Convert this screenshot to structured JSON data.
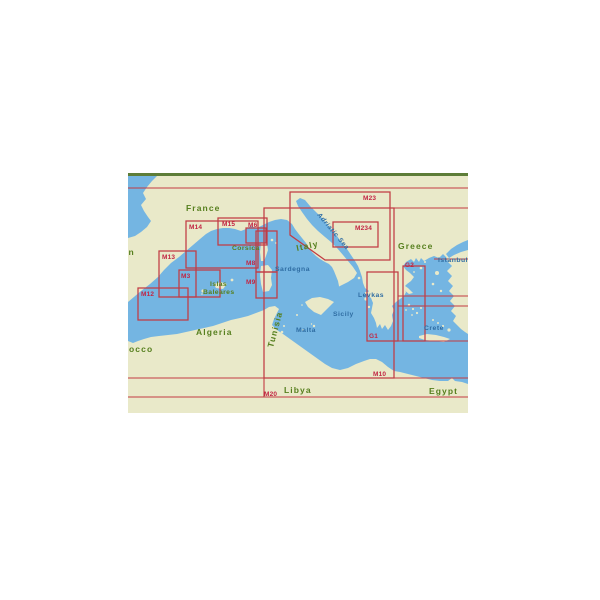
{
  "map": {
    "colors": {
      "sea": "#74b5e2",
      "land": "#e9e9c9",
      "red": "#c23b43",
      "red_text": "#c22543",
      "green_text": "#567f1e",
      "blue_text": "#2f6da3",
      "border_green": "#5d7d38",
      "background": "#ffffff"
    },
    "place_labels": [
      {
        "text": "France",
        "x": 186,
        "y": 211,
        "cls": "country",
        "rot": 0
      },
      {
        "text": "n",
        "x": 128.5,
        "y": 255,
        "cls": "country",
        "rot": 0
      },
      {
        "text": "occo",
        "x": 129,
        "y": 352,
        "cls": "country",
        "rot": 0
      },
      {
        "text": "Algeria",
        "x": 196,
        "y": 335,
        "cls": "country",
        "rot": 0
      },
      {
        "text": "Tunisia",
        "x": 273,
        "y": 348,
        "cls": "country",
        "rot": -75
      },
      {
        "text": "Libya",
        "x": 284,
        "y": 393,
        "cls": "country",
        "rot": 0
      },
      {
        "text": "Egypt",
        "x": 429,
        "y": 394,
        "cls": "country",
        "rot": 0
      },
      {
        "text": "Greece",
        "x": 398,
        "y": 249,
        "cls": "country",
        "rot": 0
      },
      {
        "text": "Italy",
        "x": 297,
        "y": 251,
        "cls": "country",
        "rot": -12
      },
      {
        "text": "Corsica",
        "x": 232,
        "y": 250,
        "cls": "country-sm",
        "rot": 0
      },
      {
        "text": "Islas",
        "x": 210,
        "y": 286,
        "cls": "country-sm",
        "rot": 0
      },
      {
        "text": "Baleares",
        "x": 203,
        "y": 294,
        "cls": "country-sm",
        "rot": 0
      },
      {
        "text": "Sardegna",
        "x": 275,
        "y": 271,
        "cls": "sea",
        "rot": 0
      },
      {
        "text": "Sicily",
        "x": 333,
        "y": 316,
        "cls": "sea",
        "rot": 0
      },
      {
        "text": "Malta",
        "x": 296,
        "y": 332,
        "cls": "sea",
        "rot": 0
      },
      {
        "text": "Levkas",
        "x": 358,
        "y": 297,
        "cls": "sea",
        "rot": 0
      },
      {
        "text": "Crete",
        "x": 424,
        "y": 330,
        "cls": "sea",
        "rot": 0
      },
      {
        "text": "Istanbul",
        "x": 438,
        "y": 262,
        "cls": "sea",
        "rot": 0
      },
      {
        "text": "Adriatic Sea",
        "x": 317,
        "y": 215,
        "cls": "sea-italic",
        "rot": 50
      }
    ],
    "chart_boxes": [
      {
        "code": "M14",
        "rect": [
          186,
          221,
          258,
          268
        ],
        "label": [
          189,
          229
        ]
      },
      {
        "code": "M15",
        "rect": [
          218,
          218,
          267,
          245
        ],
        "label": [
          222,
          226
        ]
      },
      {
        "code": "M6",
        "rect": [
          246,
          228,
          266,
          243
        ],
        "label": [
          248,
          227
        ]
      },
      {
        "code": "M8",
        "rect": [
          256,
          231,
          277,
          272
        ],
        "label": [
          246,
          265
        ]
      },
      {
        "code": "M9",
        "rect": [
          256,
          272,
          277,
          298
        ],
        "label": [
          246,
          284
        ]
      },
      {
        "code": "M13",
        "rect": [
          159,
          251,
          196,
          297
        ],
        "label": [
          162,
          259
        ]
      },
      {
        "code": "M3",
        "rect": [
          179,
          270,
          220,
          297
        ],
        "label": [
          181,
          278
        ]
      },
      {
        "code": "M12",
        "rect": [
          138,
          288,
          188,
          320
        ],
        "label": [
          141,
          296
        ]
      },
      {
        "code": "M10",
        "rect": [
          264,
          208,
          394,
          378
        ],
        "label": [
          373,
          376
        ]
      },
      {
        "code": "G1",
        "rect": [
          367,
          272,
          398,
          341
        ],
        "label": [
          369,
          338
        ]
      },
      {
        "code": "G2",
        "rect": [
          403,
          266,
          425,
          341
        ],
        "label": [
          405,
          267
        ]
      },
      {
        "code": "M234",
        "rect": [
          333,
          222,
          378,
          247
        ],
        "label": [
          355,
          230
        ]
      }
    ],
    "chart_polygons": [
      {
        "code": "M23",
        "points": [
          [
            290,
            192
          ],
          [
            390,
            192
          ],
          [
            390,
            260
          ],
          [
            325,
            260
          ],
          [
            290,
            235
          ]
        ],
        "label": [
          363,
          200
        ]
      }
    ],
    "chart_labels_outside_boxes": [
      {
        "code": "M20",
        "label": [
          264,
          396
        ]
      }
    ],
    "boundary_lines": [
      [
        128,
        188,
        468,
        188
      ],
      [
        264,
        208,
        468,
        208
      ],
      [
        434,
        259,
        468,
        259
      ],
      [
        398,
        296,
        468,
        296
      ],
      [
        398,
        306,
        468,
        306
      ],
      [
        367,
        341,
        468,
        341
      ],
      [
        128,
        378,
        468,
        378
      ],
      [
        128,
        397,
        468,
        397
      ],
      [
        264,
        378,
        264,
        397
      ]
    ]
  }
}
